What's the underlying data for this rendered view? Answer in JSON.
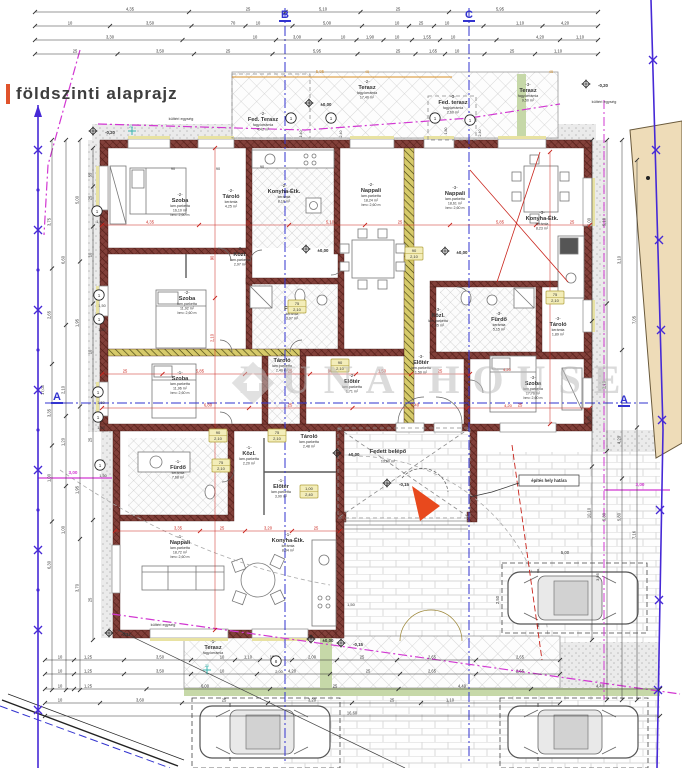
{
  "title": {
    "text": "földszinti alaprajz"
  },
  "watermark": {
    "text": "DUNA HOUSE"
  },
  "colors": {
    "dim": "#333333",
    "red": "#c9241c",
    "magenta": "#d238d2",
    "blue": "#3233cf",
    "fence": "#4629d6",
    "orange": "#d78f27",
    "cyan": "#39b5ae",
    "wall": "#7f3b34",
    "partition_yellow": "#d6ca6a",
    "terrace_green": "#c6d8a8",
    "neighbor_tan": "#eedcb8",
    "north_arrow": "#e8491d"
  },
  "section_markers": [
    {
      "label": "B",
      "x": 285,
      "y": 18
    },
    {
      "label": "C",
      "x": 469,
      "y": 18
    },
    {
      "label": "A",
      "x": 57,
      "y": 400
    },
    {
      "label": "A",
      "x": 624,
      "y": 403
    }
  ],
  "rooms": [
    {
      "u": "-2-",
      "n": "Szoba",
      "m": "lam.parketta",
      "a": "16,10 m²",
      "b": "bm= 2,60 m",
      "x": 180,
      "y": 196
    },
    {
      "u": "-2-",
      "n": "Tároló",
      "m": "kerámia",
      "a": "4,25 m²",
      "x": 231,
      "y": 192
    },
    {
      "u": "-2-",
      "n": "Konyha-Étk.",
      "m": "kerámia",
      "a": "8,10 m²",
      "x": 284,
      "y": 187
    },
    {
      "u": "-2-",
      "n": "Nappali",
      "m": "lam.parketta",
      "a": "18,24 m²",
      "b": "bm= 2,60 m",
      "x": 371,
      "y": 186
    },
    {
      "u": "-3-",
      "n": "Nappali",
      "m": "lam.parketta",
      "a": "18,61 m²",
      "b": "bm= 2,60 m",
      "x": 455,
      "y": 189
    },
    {
      "u": "-3-",
      "n": "Konyha-Étk.",
      "m": "kerámia",
      "a": "8,23 m²",
      "x": 542,
      "y": 214
    },
    {
      "u": "-2-",
      "n": "Közl.",
      "m": "lam.parketta",
      "a": "2,97 m²",
      "x": 240,
      "y": 250
    },
    {
      "u": "-2-",
      "n": "Fürdő",
      "m": "kerámia",
      "a": "3,97 m²",
      "x": 292,
      "y": 304
    },
    {
      "u": "-3-",
      "n": "Közl.",
      "m": "lam.parketta",
      "a": "1,85 m²",
      "x": 438,
      "y": 311
    },
    {
      "u": "-3-",
      "n": "Fürdő",
      "m": "kerámia",
      "a": "5,15 m²",
      "x": 499,
      "y": 315
    },
    {
      "u": "-3-",
      "n": "Tároló",
      "m": "kerámia",
      "a": "1,89 m²",
      "x": 558,
      "y": 320
    },
    {
      "u": "-3-",
      "n": "Szoba",
      "m": "lam.parketta",
      "a": "17,76 m²",
      "b": "bm= 2,60 m",
      "x": 533,
      "y": 379
    },
    {
      "u": "-3-",
      "n": "Előtér",
      "m": "lam.parketta",
      "a": "1,50 m²",
      "x": 421,
      "y": 358
    },
    {
      "u": "-2-",
      "n": "Előtér",
      "m": "lam.parketta",
      "a": "1,71 m²",
      "x": 352,
      "y": 377
    },
    {
      "u": "-2-",
      "n": "Tároló",
      "m": "lam.parketta",
      "a": "2,40 m²",
      "x": 282,
      "y": 356
    },
    {
      "u": "-2-",
      "n": "Szoba",
      "m": "lam.parketta",
      "a": "11,92 m²",
      "b": "bm= 2,60 m",
      "x": 187,
      "y": 294
    },
    {
      "u": "-1-",
      "n": "Szoba",
      "m": "lam.parketta",
      "a": "11,96 m²",
      "b": "bm= 2,60 m",
      "x": 180,
      "y": 374
    },
    {
      "u": "-1-",
      "n": "Fürdő",
      "m": "kerámia",
      "a": "7,68 m²",
      "x": 178,
      "y": 463
    },
    {
      "u": "-1-",
      "n": "Közl.",
      "m": "lam.parketta",
      "a": "2,20 m²",
      "x": 249,
      "y": 449
    },
    {
      "u": "-1-",
      "n": "Tároló",
      "m": "lam.parketta",
      "a": "2,48 m²",
      "x": 309,
      "y": 432
    },
    {
      "u": "-1-",
      "n": "Előtér",
      "m": "lam.parketta",
      "a": "3,90 m²",
      "x": 281,
      "y": 482
    },
    {
      "u": "-1-",
      "n": "Nappali",
      "m": "lam.parketta",
      "a": "18,72 m²",
      "b": "bm= 2,60 m",
      "x": 180,
      "y": 538
    },
    {
      "u": "-1-",
      "n": "Konyha-Étk.",
      "m": "kerámia",
      "a": "8,04 m²",
      "x": 288,
      "y": 536
    },
    {
      "u": "-1-",
      "n": "Terasz",
      "m": "fagy.kerámia",
      "a": "",
      "x": 213,
      "y": 643
    },
    {
      "u": "",
      "n": "Fedett belépő",
      "m": "",
      "a": "13,60 m²",
      "x": 388,
      "y": 447
    },
    {
      "u": "-2-",
      "n": "Terasz",
      "m": "fagy.kerámia",
      "a": "17,40 m²",
      "x": 367,
      "y": 83
    },
    {
      "u": "-2-",
      "n": "Fed. Terasz",
      "m": "fagy.kerámia",
      "a": "4,42 m²",
      "x": 263,
      "y": 115
    },
    {
      "u": "-3-",
      "n": "Terasz",
      "m": "fagy.kerámia",
      "a": "9,50 m²",
      "x": 528,
      "y": 86
    },
    {
      "u": "-3-",
      "n": "Fed. terasz",
      "m": "fagy.kerámia",
      "a": "2,60 m²",
      "x": 453,
      "y": 98
    }
  ],
  "elevations": [
    {
      "t": "-0,20",
      "x": 106,
      "y": 134
    },
    {
      "t": "-0,20",
      "x": 599,
      "y": 87
    },
    {
      "t": "±0,00",
      "x": 322,
      "y": 106
    },
    {
      "t": "±0,00",
      "x": 319,
      "y": 252
    },
    {
      "t": "±0,00",
      "x": 458,
      "y": 254
    },
    {
      "t": "±0,00",
      "x": 350,
      "y": 456
    },
    {
      "t": "±0,00",
      "x": 324,
      "y": 642
    },
    {
      "t": "-0,15",
      "x": 400,
      "y": 486
    },
    {
      "t": "-0,15",
      "x": 354,
      "y": 646
    },
    {
      "t": "-0,17",
      "x": 122,
      "y": 636
    }
  ],
  "door_tags": [
    {
      "x": 340,
      "y": 364,
      "w": "90",
      "h": "2,10"
    },
    {
      "x": 218,
      "y": 434,
      "w": "90",
      "h": "2,10"
    },
    {
      "x": 277,
      "y": 434,
      "w": "75",
      "h": "2,10"
    },
    {
      "x": 221,
      "y": 464,
      "w": "75",
      "h": "2,10"
    },
    {
      "x": 555,
      "y": 296,
      "w": "75",
      "h": "2,10"
    },
    {
      "x": 309,
      "y": 490,
      "w": "1,00",
      "h": "2,40"
    },
    {
      "x": 297,
      "y": 305,
      "w": "75",
      "h": "2,10"
    },
    {
      "x": 414,
      "y": 252,
      "w": "90",
      "h": "2,10"
    }
  ],
  "window_tags": [
    {
      "x": 97,
      "y": 211,
      "n": "1",
      "d": "1,50"
    },
    {
      "x": 99,
      "y": 295,
      "n": "1",
      "d": "1,50"
    },
    {
      "x": 99,
      "y": 319,
      "n": "1",
      "d": "1,50"
    },
    {
      "x": 98,
      "y": 392,
      "n": "1",
      "d": "1,50"
    },
    {
      "x": 98,
      "y": 417,
      "n": "1",
      "d": "1,50"
    },
    {
      "x": 100,
      "y": 465,
      "n": "1",
      "d": "1,50"
    },
    {
      "x": 291,
      "y": 118,
      "n": "1",
      "d": ""
    },
    {
      "x": 331,
      "y": 118,
      "n": "1",
      "d": ""
    },
    {
      "x": 435,
      "y": 118,
      "n": "1",
      "d": ""
    },
    {
      "x": 470,
      "y": 120,
      "n": "1",
      "d": ""
    },
    {
      "x": 276,
      "y": 661,
      "n": "8",
      "d": "2,00"
    }
  ],
  "dim_rows": [
    {
      "y": 12,
      "x1": 35,
      "x2": 598,
      "l": [
        [
          130,
          "4,35"
        ],
        [
          248,
          "25"
        ],
        [
          323,
          "5,10"
        ],
        [
          398,
          "25"
        ],
        [
          500,
          "5,95"
        ]
      ]
    },
    {
      "y": 26,
      "x1": 35,
      "x2": 598,
      "l": [
        [
          70,
          "10"
        ],
        [
          150,
          "3,50"
        ],
        [
          233,
          "70"
        ],
        [
          258,
          "10"
        ],
        [
          327,
          "5,00"
        ],
        [
          397,
          "10"
        ],
        [
          421,
          "25"
        ],
        [
          447,
          "10"
        ],
        [
          520,
          "1,10"
        ],
        [
          565,
          "4,20"
        ]
      ]
    },
    {
      "y": 40,
      "x1": 35,
      "x2": 598,
      "l": [
        [
          110,
          "3,30"
        ],
        [
          255,
          "10"
        ],
        [
          297,
          "3,00"
        ],
        [
          343,
          "10"
        ],
        [
          370,
          "1,90"
        ],
        [
          397,
          "10"
        ],
        [
          427,
          "1,55"
        ],
        [
          453,
          "10"
        ],
        [
          540,
          "4,20"
        ],
        [
          580,
          "1,10"
        ]
      ]
    },
    {
      "y": 54,
      "x1": 35,
      "x2": 598,
      "l": [
        [
          75,
          "25"
        ],
        [
          160,
          "3,50"
        ],
        [
          228,
          "25"
        ],
        [
          317,
          "5,95"
        ],
        [
          398,
          "25"
        ],
        [
          433,
          "1,65"
        ],
        [
          457,
          "10"
        ],
        [
          512,
          "25"
        ],
        [
          558,
          "1,10"
        ]
      ]
    },
    {
      "y": 660,
      "x1": 45,
      "x2": 560,
      "l": [
        [
          60,
          "10"
        ],
        [
          88,
          "1,25"
        ],
        [
          160,
          "3,50"
        ],
        [
          222,
          "10"
        ],
        [
          248,
          "1,10"
        ],
        [
          272,
          "10"
        ],
        [
          312,
          "2,00"
        ],
        [
          362,
          "25"
        ],
        [
          432,
          "2,65"
        ],
        [
          520,
          "2,65"
        ]
      ]
    },
    {
      "y": 674,
      "x1": 45,
      "x2": 560,
      "l": [
        [
          60,
          "10"
        ],
        [
          88,
          "1,25"
        ],
        [
          160,
          "3,50"
        ],
        [
          222,
          "10"
        ],
        [
          292,
          "4,20"
        ],
        [
          368,
          "25"
        ],
        [
          432,
          "2,65"
        ],
        [
          520,
          "2,65"
        ]
      ]
    },
    {
      "y": 689,
      "x1": 45,
      "x2": 660,
      "l": [
        [
          60,
          "10"
        ],
        [
          88,
          "1,25"
        ],
        [
          205,
          "6,00"
        ],
        [
          335,
          "25"
        ],
        [
          462,
          "4,40"
        ],
        [
          600,
          "4,40"
        ]
      ]
    },
    {
      "y": 703,
      "x1": 45,
      "x2": 560,
      "l": [
        [
          60,
          "10"
        ],
        [
          140,
          "3,60"
        ],
        [
          224,
          "25"
        ],
        [
          312,
          "3,20"
        ],
        [
          392,
          "25"
        ],
        [
          450,
          "1,10"
        ]
      ]
    },
    {
      "y": 716,
      "x1": 45,
      "x2": 660,
      "l": [
        [
          352,
          "16,60"
        ]
      ]
    }
  ],
  "dim_cols": [
    {
      "x": 52,
      "y1": 140,
      "y2": 690,
      "l": [
        [
          222,
          "3,75"
        ],
        [
          315,
          "2,65"
        ],
        [
          413,
          "3,35"
        ],
        [
          478,
          "1,00"
        ],
        [
          565,
          "6,30"
        ]
      ]
    },
    {
      "x": 66,
      "y1": 140,
      "y2": 690,
      "l": [
        [
          260,
          "6,60"
        ],
        [
          390,
          "2,10"
        ],
        [
          442,
          "1,20"
        ],
        [
          530,
          "1,00"
        ]
      ]
    },
    {
      "x": 80,
      "y1": 140,
      "y2": 690,
      "l": [
        [
          200,
          "5,00"
        ],
        [
          323,
          "1,95"
        ],
        [
          490,
          "1,95"
        ],
        [
          588,
          "3,70"
        ]
      ]
    },
    {
      "x": 93,
      "y1": 148,
      "y2": 640,
      "l": [
        [
          175,
          "55"
        ],
        [
          198,
          "25"
        ],
        [
          255,
          "10"
        ],
        [
          352,
          "10"
        ],
        [
          440,
          "25"
        ],
        [
          600,
          "25"
        ]
      ]
    },
    {
      "x": 592,
      "y1": 140,
      "y2": 640,
      "l": [
        [
          222,
          "5,00"
        ],
        [
          420,
          "1,95"
        ],
        [
          513,
          "10,10"
        ]
      ]
    },
    {
      "x": 607,
      "y1": 140,
      "y2": 700,
      "l": [
        [
          222,
          "5,10"
        ],
        [
          385,
          "2,10"
        ],
        [
          517,
          "5,80"
        ]
      ]
    },
    {
      "x": 622,
      "y1": 140,
      "y2": 700,
      "l": [
        [
          260,
          "3,10"
        ],
        [
          440,
          "4,20"
        ],
        [
          517,
          "5,80"
        ]
      ]
    },
    {
      "x": 637,
      "y1": 160,
      "y2": 700,
      "l": [
        [
          320,
          "7,05"
        ],
        [
          535,
          "7,16"
        ]
      ]
    }
  ],
  "red_rows": [
    {
      "y": 225,
      "x1": 102,
      "x2": 590,
      "l": [
        [
          150,
          "4,35"
        ],
        [
          248,
          "25"
        ],
        [
          330,
          "5,10"
        ],
        [
          400,
          "25"
        ],
        [
          500,
          "5,85"
        ],
        [
          572,
          "25"
        ]
      ]
    },
    {
      "y": 374,
      "x1": 102,
      "x2": 470,
      "l": [
        [
          125,
          "25"
        ],
        [
          200,
          "5,85"
        ],
        [
          290,
          "25"
        ],
        [
          330,
          "90"
        ],
        [
          382,
          "1,50"
        ],
        [
          440,
          "25"
        ]
      ]
    },
    {
      "y": 408,
      "x1": 102,
      "x2": 590,
      "l": [
        [
          208,
          "6,80"
        ],
        [
          290,
          "25"
        ],
        [
          415,
          "6,40"
        ],
        [
          520,
          "25"
        ]
      ]
    },
    {
      "y": 531,
      "x1": 115,
      "x2": 340,
      "l": [
        [
          178,
          "3,35"
        ],
        [
          222,
          "25"
        ],
        [
          268,
          "3,20"
        ],
        [
          316,
          "25"
        ]
      ]
    }
  ],
  "red_cols": [
    {
      "x": 215,
      "y1": 148,
      "y2": 630,
      "l": [
        [
          258,
          "90"
        ],
        [
          338,
          "2,10"
        ]
      ]
    },
    {
      "x": 550,
      "y1": 152,
      "y2": 424,
      "l": []
    }
  ],
  "labels": [
    {
      "t": "kültéri egység",
      "x": 181,
      "y": 120,
      "s": 4
    },
    {
      "t": "kültéri egység",
      "x": 604,
      "y": 103,
      "s": 4
    },
    {
      "t": "kültéri egység",
      "x": 163,
      "y": 626,
      "s": 4
    },
    {
      "t": "építés hely határa",
      "x": 549,
      "y": 482,
      "s": 4.2,
      "b": 1
    },
    {
      "t": "1,50",
      "x": 351,
      "y": 606,
      "s": 4
    },
    {
      "t": "5,00",
      "x": 565,
      "y": 554,
      "s": 4.2
    },
    {
      "t": "2,50",
      "x": 499,
      "y": 600,
      "s": 4.2,
      "r": -90
    },
    {
      "t": "3,95",
      "x": 599,
      "y": 577,
      "s": 4,
      "r": -90
    },
    {
      "t": "3,00",
      "x": 73,
      "y": 474,
      "s": 4.6,
      "c": "magenta",
      "b": 1
    },
    {
      "t": "3,00",
      "x": 640,
      "y": 486,
      "s": 4.6,
      "c": "magenta",
      "b": 1
    },
    {
      "t": "17,05",
      "x": 44,
      "y": 390,
      "s": 4,
      "r": -90
    },
    {
      "t": "5,95",
      "x": 320,
      "y": 73,
      "s": 4.2,
      "c": "orange"
    },
    {
      "t": "45",
      "x": 367,
      "y": 73,
      "s": 4,
      "c": "orange"
    },
    {
      "t": "45",
      "x": 551,
      "y": 73,
      "s": 4,
      "c": "orange"
    },
    {
      "t": "90",
      "x": 173,
      "y": 170,
      "s": 3.8
    },
    {
      "t": "90",
      "x": 218,
      "y": 170,
      "s": 3.8
    },
    {
      "t": "90",
      "x": 262,
      "y": 168,
      "s": 3.8
    },
    {
      "t": "4,20",
      "x": 507,
      "y": 371,
      "s": 4,
      "c": "red"
    },
    {
      "t": "4,20",
      "x": 508,
      "y": 407,
      "s": 4,
      "c": "red"
    },
    {
      "t": "1,40",
      "x": 302,
      "y": 134,
      "s": 3.6,
      "r": -90
    },
    {
      "t": "2,40",
      "x": 342,
      "y": 134,
      "s": 3.6,
      "r": -90
    },
    {
      "t": "1,80",
      "x": 447,
      "y": 131,
      "s": 3.6,
      "r": -90
    },
    {
      "t": "2,40",
      "x": 481,
      "y": 133,
      "s": 3.6,
      "r": -90
    },
    {
      "t": "20",
      "x": 131,
      "y": 128,
      "s": 3.6,
      "c": "cyan"
    },
    {
      "t": "20",
      "x": 207,
      "y": 667,
      "s": 3.6,
      "c": "cyan"
    }
  ]
}
